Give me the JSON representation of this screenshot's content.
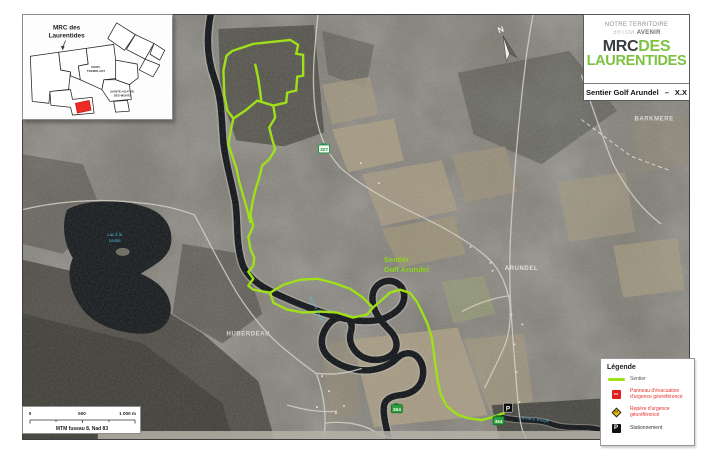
{
  "header": {
    "tagline_top": "NOTRE TERRITOIRE",
    "tagline_mirrored": "NOTRE",
    "tagline_bottom_bold": "AVENIR",
    "logo": {
      "mrc": "MRC",
      "des": "DES",
      "laurentides": "LAURENTIDES",
      "green": "#7DC242",
      "charcoal": "#383E42"
    },
    "title": "Sentier Golf Arundel",
    "title_separator": "–",
    "title_code": "X.X"
  },
  "inset": {
    "callout_line1": "MRC des",
    "callout_line2": "Laurentides",
    "label_mont_tremblant_line1": "MONT-",
    "label_mont_tremblant_line2": "TREMBLANT",
    "label_sainte_agathe_line1": "SAINTE-AGATHE-",
    "label_sainte_agathe_line2": "DES-MONTS",
    "highlight_color": "#EE2B24"
  },
  "map": {
    "trail_color": "#9FE019",
    "labels": {
      "barkmere": "BARKMERE",
      "arundel": "ARUNDEL",
      "huberdeau": "HUBERDEAU",
      "trail_line1": "Sentier",
      "trail_line2": "Golf Arundel",
      "lake_line1": "Lac à la",
      "lake_line2": "Loutre",
      "river": "Rivière Rouge",
      "north": "N",
      "route_327": "327",
      "route_364": "364",
      "parking": "P"
    }
  },
  "legend": {
    "title": "Légende",
    "items": [
      {
        "name": "sentier",
        "line1": "Sentier",
        "line2": ""
      },
      {
        "name": "panneau-evacuation",
        "line1": "Panneau d'évacuation",
        "line2": "d'urgence géoréférencé"
      },
      {
        "name": "repere-urgence",
        "line1": "Repère d'urgence",
        "line2": "géoréférencé"
      },
      {
        "name": "stationnement",
        "line1": "Stationnement",
        "line2": ""
      }
    ],
    "icon_911": "911",
    "icon_p": "P",
    "red": "#E8312A",
    "yellow": "#F6C80A"
  },
  "scalebar": {
    "t0": "0",
    "t500": "500",
    "t1000": "1 000 m",
    "datum": "MTM fuseau 8, Nad 83"
  }
}
